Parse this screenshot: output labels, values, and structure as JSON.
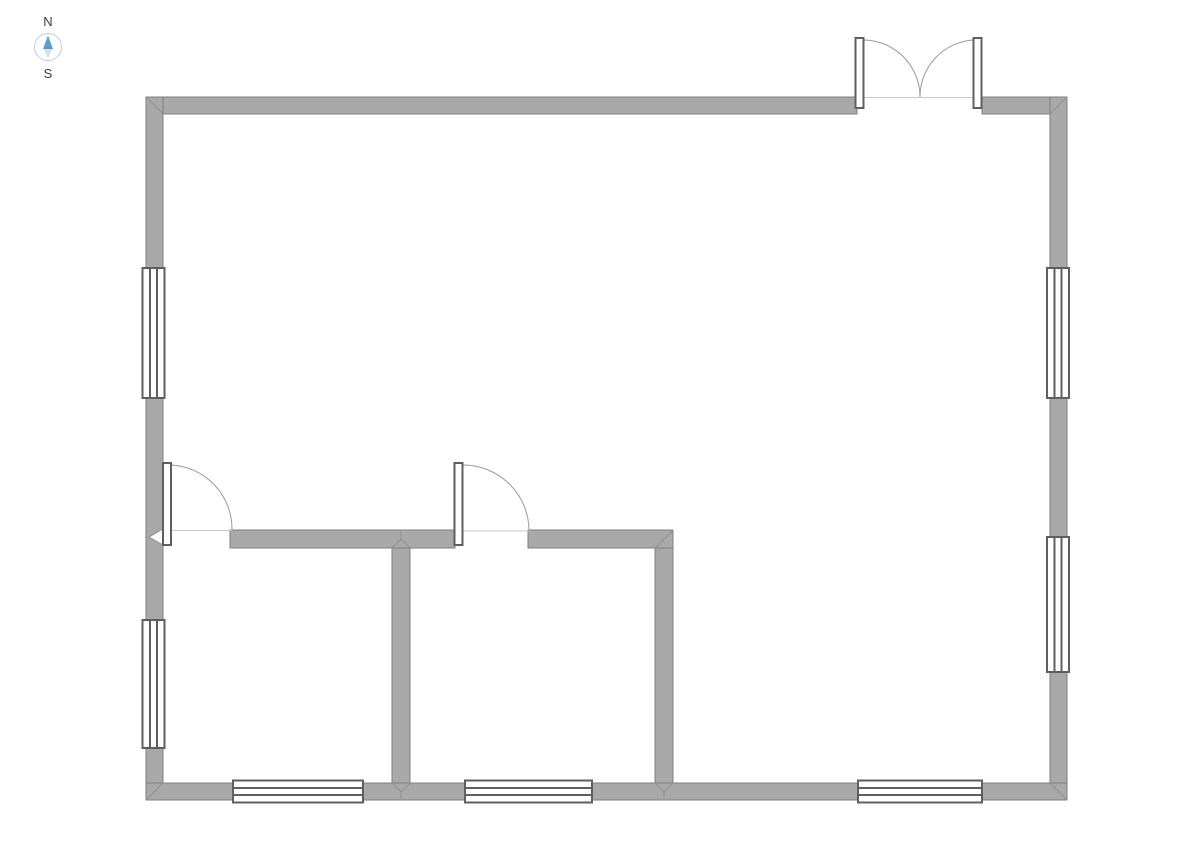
{
  "compass": {
    "north_label": "N",
    "south_label": "S",
    "ring_color": "#b7cfe9",
    "needle_north_color": "#5b9bd5",
    "needle_south_color": "#dcdcdc"
  },
  "palette": {
    "wall_fill": "#a9a9a9",
    "wall_stroke": "#7f7f7f",
    "seam_stroke": "#8f8f8f",
    "frame_stroke": "#5f5f5f",
    "threshold_stroke": "#c9c9c9",
    "swing_stroke": "#9a9a9a",
    "glass_fill": "#ffffff"
  },
  "plan": {
    "walls": [
      {
        "name": "top-wall-left-of-entry",
        "x": 146,
        "y": 97,
        "w": 711,
        "h": 17
      },
      {
        "name": "top-wall-right-of-entry",
        "x": 982,
        "y": 97,
        "w": 85,
        "h": 17
      },
      {
        "name": "left-exterior-wall",
        "x": 146,
        "y": 97,
        "w": 17,
        "h": 703
      },
      {
        "name": "right-exterior-wall",
        "x": 1050,
        "y": 97,
        "w": 17,
        "h": 703
      },
      {
        "name": "bottom-exterior-wall",
        "x": 146,
        "y": 783,
        "w": 921,
        "h": 17
      },
      {
        "name": "interior-wall-horizontal-left",
        "x": 230,
        "y": 530,
        "w": 225,
        "h": 18
      },
      {
        "name": "interior-wall-horizontal-right",
        "x": 528,
        "y": 530,
        "w": 145,
        "h": 18
      },
      {
        "name": "interior-wall-vertical-left",
        "x": 392,
        "y": 548,
        "w": 18,
        "h": 235
      },
      {
        "name": "interior-wall-vertical-right",
        "x": 655,
        "y": 548,
        "w": 18,
        "h": 235
      }
    ],
    "seams": [
      {
        "x1": 146,
        "y1": 97,
        "x2": 163,
        "y2": 114
      },
      {
        "x1": 1067,
        "y1": 97,
        "x2": 1050,
        "y2": 114
      },
      {
        "x1": 146,
        "y1": 800,
        "x2": 163,
        "y2": 783
      },
      {
        "x1": 1067,
        "y1": 800,
        "x2": 1050,
        "y2": 783
      },
      {
        "x1": 673,
        "y1": 530,
        "x2": 655,
        "y2": 548
      },
      {
        "x1": 392,
        "y1": 548,
        "x2": 401,
        "y2": 539
      },
      {
        "x1": 410,
        "y1": 548,
        "x2": 401,
        "y2": 539
      },
      {
        "x1": 401,
        "y1": 539,
        "x2": 401,
        "y2": 531
      },
      {
        "x1": 392,
        "y1": 783,
        "x2": 401,
        "y2": 792
      },
      {
        "x1": 410,
        "y1": 783,
        "x2": 401,
        "y2": 792
      },
      {
        "x1": 401,
        "y1": 792,
        "x2": 401,
        "y2": 799
      },
      {
        "x1": 655,
        "y1": 783,
        "x2": 664,
        "y2": 792
      },
      {
        "x1": 673,
        "y1": 783,
        "x2": 664,
        "y2": 792
      },
      {
        "x1": 664,
        "y1": 792,
        "x2": 664,
        "y2": 799
      },
      {
        "x1": 146,
        "y1": 537,
        "x2": 149,
        "y2": 537
      }
    ],
    "wall_notch": {
      "name": "left-wall-notch",
      "path": "M 163 529 L 149 537 L 163 545"
    },
    "windows": [
      {
        "name": "window-left-upper",
        "orientation": "v",
        "cx": 153.5,
        "start": 268,
        "length": 130
      },
      {
        "name": "window-left-lower",
        "orientation": "v",
        "cx": 153.5,
        "start": 620,
        "length": 128
      },
      {
        "name": "window-right-upper",
        "orientation": "v",
        "cx": 1058,
        "start": 268,
        "length": 130
      },
      {
        "name": "window-right-lower",
        "orientation": "v",
        "cx": 1058,
        "start": 537,
        "length": 135
      },
      {
        "name": "window-bottom-left-room",
        "orientation": "h",
        "cy": 791.5,
        "start": 233,
        "length": 130
      },
      {
        "name": "window-bottom-middle-room",
        "orientation": "h",
        "cy": 791.5,
        "start": 465,
        "length": 127
      },
      {
        "name": "window-bottom-right",
        "orientation": "h",
        "cy": 791.5,
        "start": 858,
        "length": 124
      }
    ],
    "doors": [
      {
        "name": "entry-double-door",
        "thresholds": [
          {
            "x1": 857,
            "y1": 97.5,
            "x2": 982,
            "y2": 97.5
          }
        ],
        "leaves": [
          {
            "x": 855.5,
            "y": 38,
            "w": 8,
            "h": 70
          },
          {
            "x": 973.5,
            "y": 38,
            "w": 8,
            "h": 70
          }
        ],
        "swings": [
          "M 863.5 40 A 57 57 0 0 1 920 97",
          "M 973.5 40 A 57 57 0 0 0 920 97"
        ]
      },
      {
        "name": "left-room-door",
        "thresholds": [
          {
            "x1": 163,
            "y1": 530.5,
            "x2": 232,
            "y2": 530.5
          }
        ],
        "leaves": [
          {
            "x": 163,
            "y": 463,
            "w": 8,
            "h": 82
          }
        ],
        "swings": [
          "M 171 465 A 64 64 0 0 1 232 530"
        ]
      },
      {
        "name": "middle-room-door",
        "thresholds": [
          {
            "x1": 455,
            "y1": 531,
            "x2": 529,
            "y2": 531
          }
        ],
        "leaves": [
          {
            "x": 454.5,
            "y": 463,
            "w": 8,
            "h": 82
          }
        ],
        "swings": [
          "M 462.5 465 A 66 66 0 0 1 529 531"
        ]
      }
    ]
  }
}
